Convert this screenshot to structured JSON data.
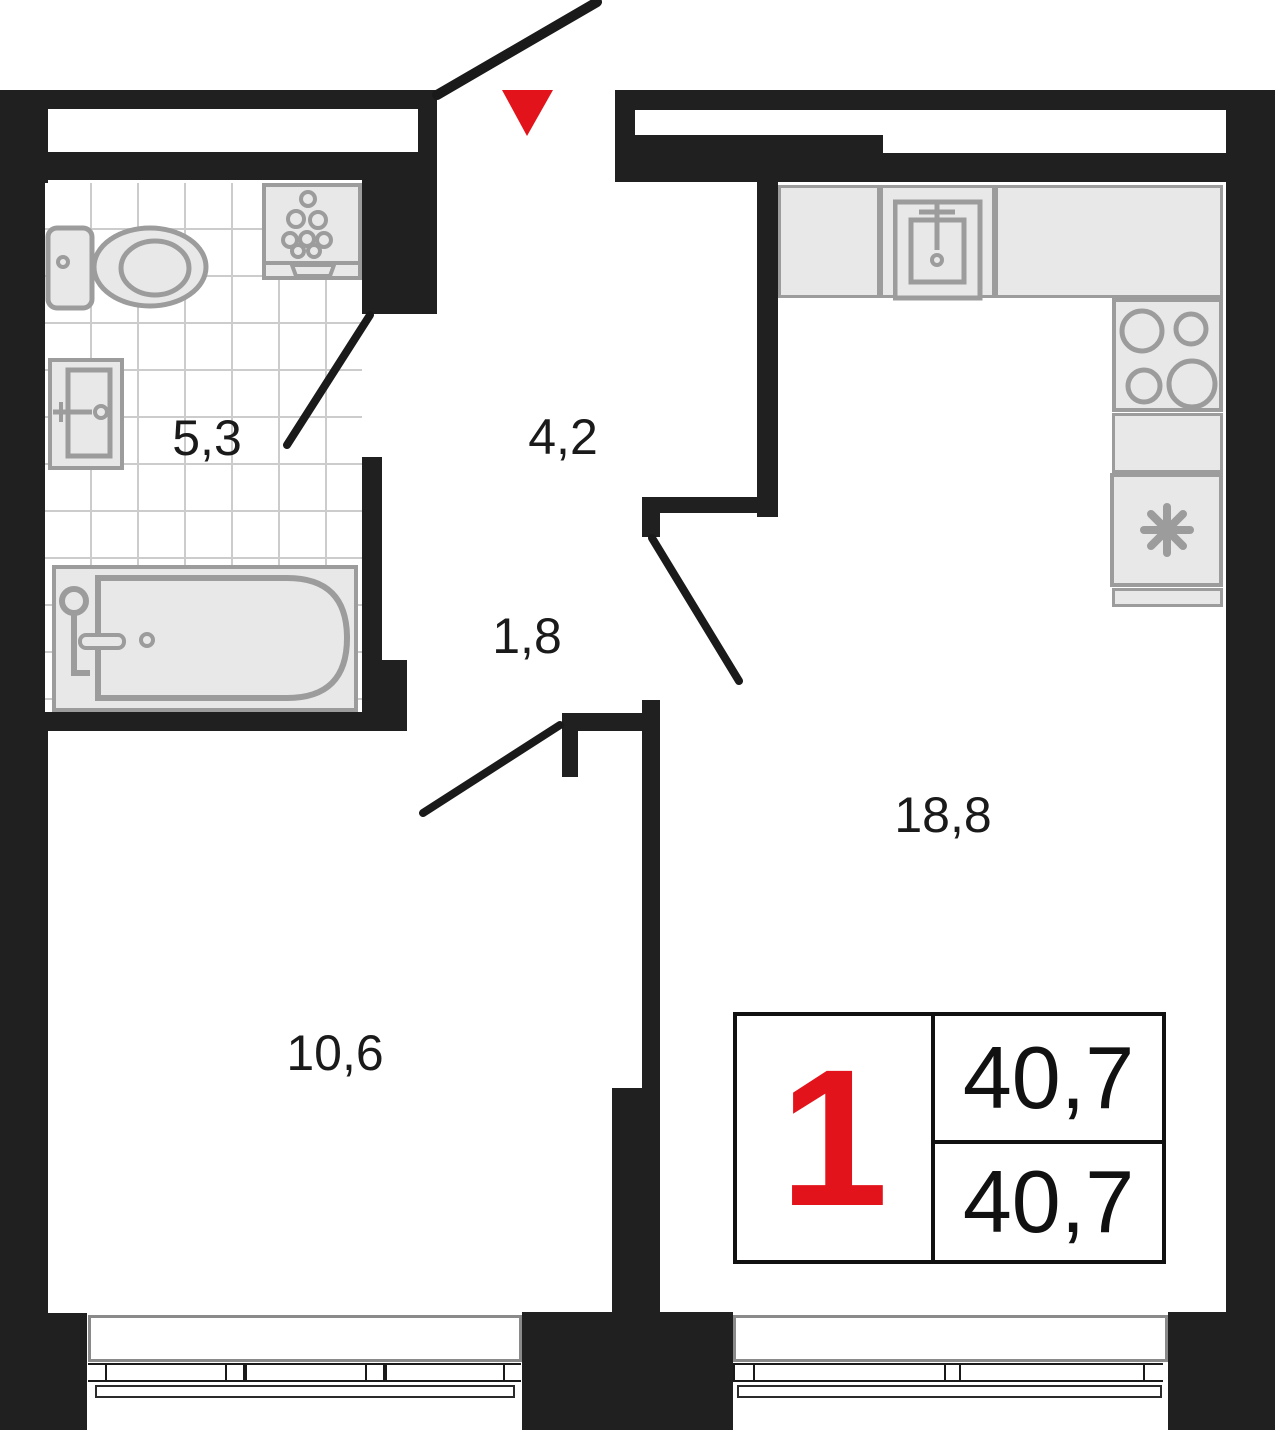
{
  "plan": {
    "title": "1-room apartment floor plan",
    "rooms": {
      "bathroom": {
        "name": "bathroom",
        "area": "5,3"
      },
      "hallway": {
        "name": "entrance hall",
        "area": "4,2"
      },
      "corridor": {
        "name": "corridor",
        "area": "1,8"
      },
      "bedroom": {
        "name": "bedroom",
        "area": "10,6"
      },
      "living_kitchen": {
        "name": "kitchen-living",
        "area": "18,8"
      }
    },
    "info_badge": {
      "rooms_count": "1",
      "area_top": "40,7",
      "area_bottom": "40,7"
    },
    "icons": {
      "entrance_marker": "red-triangle-down",
      "bathroom_fixtures": [
        "toilet",
        "washing-machine",
        "sink",
        "bathtub"
      ],
      "kitchen_fixtures": [
        "kitchen-sink",
        "stove-4-burners",
        "fridge-asterisk"
      ]
    },
    "colors": {
      "wall": "#202020",
      "accent_red": "#e3131b",
      "fixture_stroke": "#9c9c9c",
      "fixture_fill": "#e8e8e8",
      "tile_line": "#cccccc",
      "text": "#1a1a1a"
    }
  }
}
